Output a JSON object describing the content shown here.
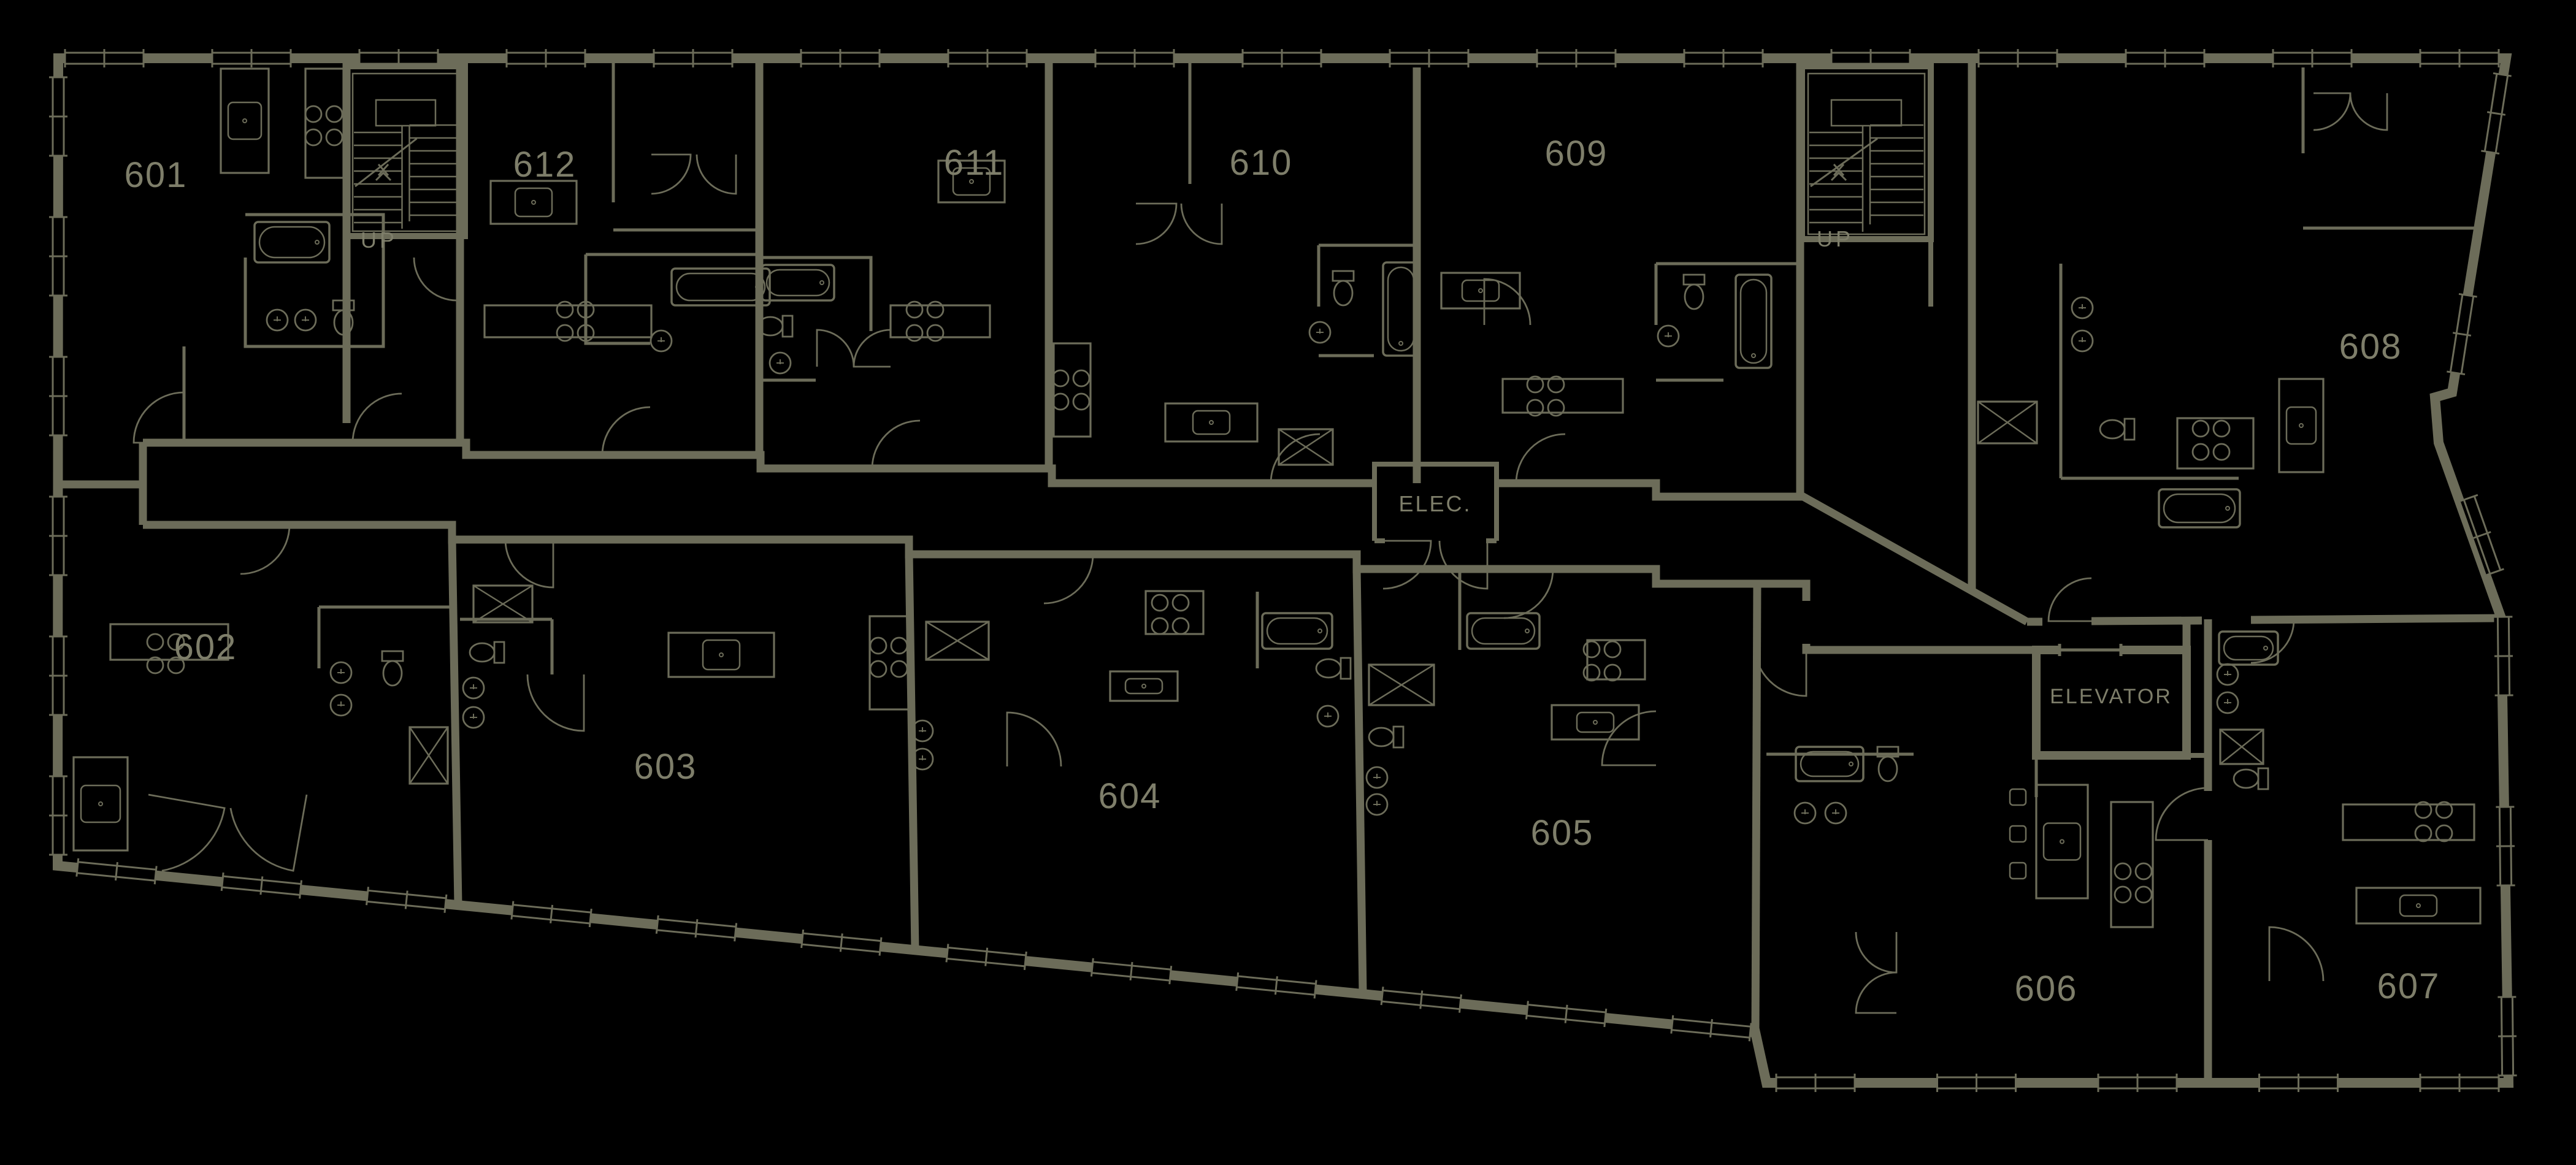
{
  "colors": {
    "background": "#000000",
    "line": "#6c6c59",
    "label": "#7e7e6a"
  },
  "units": [
    {
      "id": "601",
      "label": "601"
    },
    {
      "id": "612",
      "label": "612"
    },
    {
      "id": "611",
      "label": "611"
    },
    {
      "id": "610",
      "label": "610"
    },
    {
      "id": "609",
      "label": "609"
    },
    {
      "id": "608",
      "label": "608"
    },
    {
      "id": "602",
      "label": "602"
    },
    {
      "id": "603",
      "label": "603"
    },
    {
      "id": "604",
      "label": "604"
    },
    {
      "id": "605",
      "label": "605"
    },
    {
      "id": "606",
      "label": "606"
    },
    {
      "id": "607",
      "label": "607"
    }
  ],
  "rooms": {
    "electrical": {
      "label": "ELEC."
    },
    "elevator": {
      "label": "ELEVATOR"
    }
  },
  "stairs": {
    "left": {
      "label": "UP"
    },
    "right": {
      "label": "UP"
    }
  }
}
